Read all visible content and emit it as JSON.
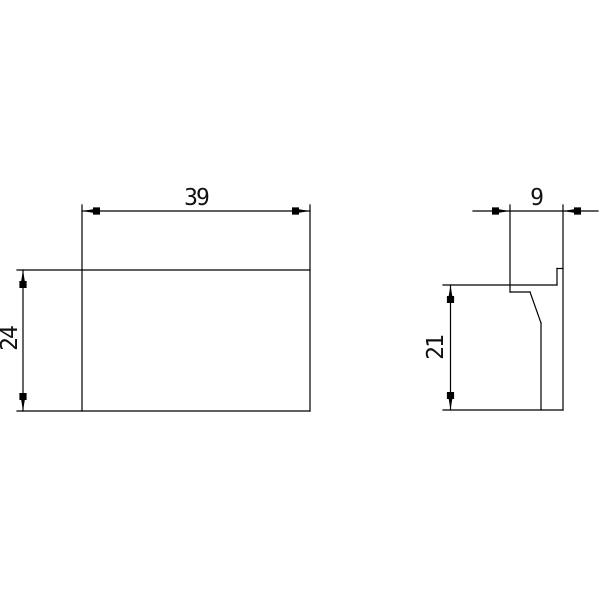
{
  "drawing": {
    "background_color": "#ffffff",
    "line_color": "#000000",
    "views": {
      "front": {
        "width_label": "39",
        "height_label": "24"
      },
      "side": {
        "depth_label": "9",
        "height_label": "21"
      }
    }
  }
}
